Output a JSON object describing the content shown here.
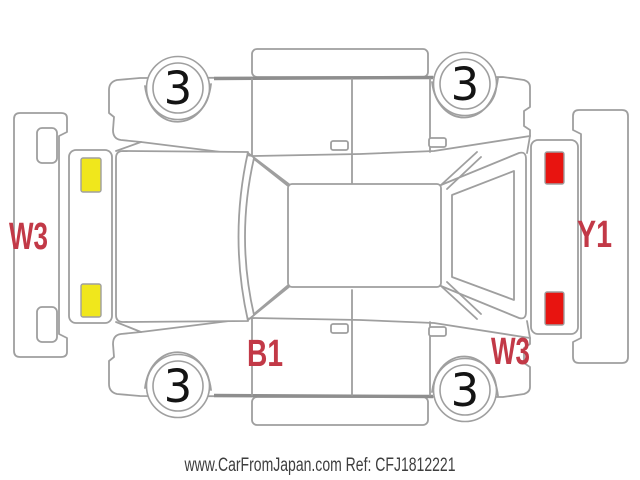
{
  "diagram": {
    "tire_marks": {
      "top_left": "3",
      "top_right": "3",
      "bottom_left": "3",
      "bottom_right": "3"
    },
    "damage_codes": {
      "left": "W3",
      "right": "Y1",
      "bottom_center": "B1",
      "bottom_right": "W3"
    },
    "colors": {
      "marker_yellow": "#f0e71c",
      "marker_red": "#e81410",
      "code_red": "#c23947",
      "outline_gray": "#9f9f9f",
      "footer_gray": "#3e3e3e"
    }
  },
  "footer": {
    "text": "www.CarFromJapan.com Ref: CFJ1812221"
  }
}
